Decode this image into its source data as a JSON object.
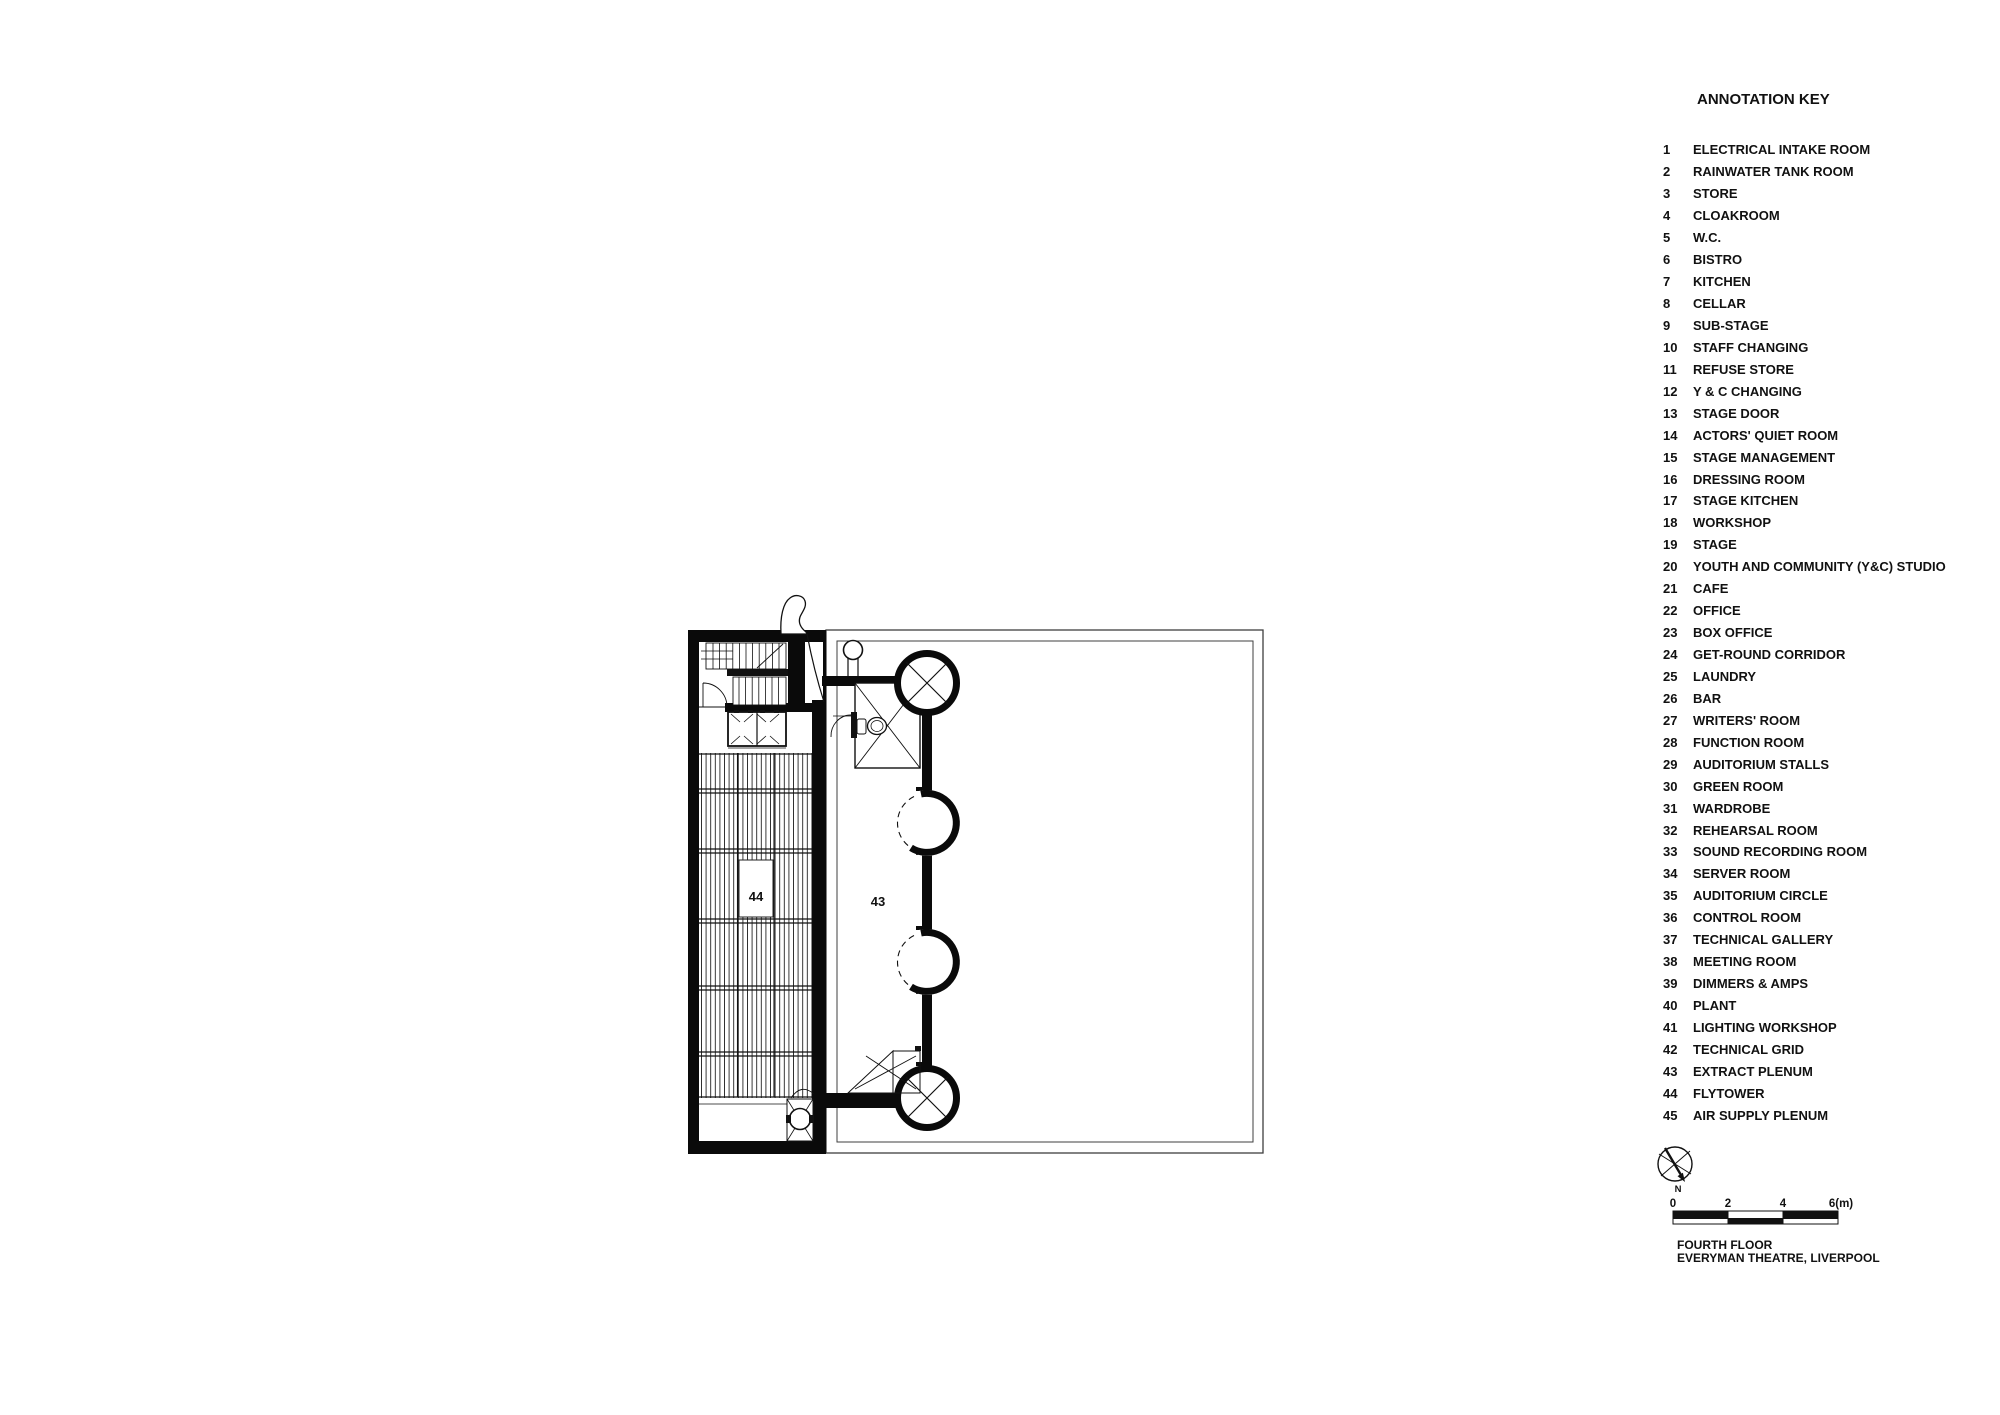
{
  "annotation_key": {
    "title": "ANNOTATION KEY",
    "items": [
      {
        "num": "1",
        "label": "ELECTRICAL INTAKE ROOM"
      },
      {
        "num": "2",
        "label": "RAINWATER TANK ROOM"
      },
      {
        "num": "3",
        "label": "STORE"
      },
      {
        "num": "4",
        "label": "CLOAKROOM"
      },
      {
        "num": "5",
        "label": "W.C."
      },
      {
        "num": "6",
        "label": "BISTRO"
      },
      {
        "num": "7",
        "label": "KITCHEN"
      },
      {
        "num": "8",
        "label": "CELLAR"
      },
      {
        "num": "9",
        "label": "SUB-STAGE"
      },
      {
        "num": "10",
        "label": "STAFF CHANGING"
      },
      {
        "num": "11",
        "label": "REFUSE STORE"
      },
      {
        "num": "12",
        "label": "Y & C CHANGING"
      },
      {
        "num": "13",
        "label": "STAGE DOOR"
      },
      {
        "num": "14",
        "label": "ACTORS' QUIET ROOM"
      },
      {
        "num": "15",
        "label": "STAGE MANAGEMENT"
      },
      {
        "num": "16",
        "label": "DRESSING ROOM"
      },
      {
        "num": "17",
        "label": "STAGE KITCHEN"
      },
      {
        "num": "18",
        "label": "WORKSHOP"
      },
      {
        "num": "19",
        "label": "STAGE"
      },
      {
        "num": "20",
        "label": "YOUTH AND COMMUNITY (Y&C) STUDIO"
      },
      {
        "num": "21",
        "label": "CAFE"
      },
      {
        "num": "22",
        "label": "OFFICE"
      },
      {
        "num": "23",
        "label": "BOX OFFICE"
      },
      {
        "num": "24",
        "label": "GET-ROUND CORRIDOR"
      },
      {
        "num": "25",
        "label": "LAUNDRY"
      },
      {
        "num": "26",
        "label": "BAR"
      },
      {
        "num": "27",
        "label": "WRITERS' ROOM"
      },
      {
        "num": "28",
        "label": "FUNCTION ROOM"
      },
      {
        "num": "29",
        "label": "AUDITORIUM STALLS"
      },
      {
        "num": "30",
        "label": "GREEN ROOM"
      },
      {
        "num": "31",
        "label": "WARDROBE"
      },
      {
        "num": "32",
        "label": "REHEARSAL ROOM"
      },
      {
        "num": "33",
        "label": "SOUND RECORDING ROOM"
      },
      {
        "num": "34",
        "label": "SERVER ROOM"
      },
      {
        "num": "35",
        "label": "AUDITORIUM CIRCLE"
      },
      {
        "num": "36",
        "label": "CONTROL ROOM"
      },
      {
        "num": "37",
        "label": "TECHNICAL GALLERY"
      },
      {
        "num": "38",
        "label": "MEETING ROOM"
      },
      {
        "num": "39",
        "label": "DIMMERS & AMPS"
      },
      {
        "num": "40",
        "label": "PLANT"
      },
      {
        "num": "41",
        "label": "LIGHTING WORKSHOP"
      },
      {
        "num": "42",
        "label": "TECHNICAL GRID"
      },
      {
        "num": "43",
        "label": "EXTRACT PLENUM"
      },
      {
        "num": "44",
        "label": "FLYTOWER"
      },
      {
        "num": "45",
        "label": "AIR SUPPLY PLENUM"
      }
    ]
  },
  "plan": {
    "labels": {
      "flytower": "44",
      "extract_plenum": "43"
    },
    "north_label": "N",
    "scale": {
      "ticks": [
        "0",
        "2",
        "4",
        "6(m)"
      ]
    },
    "title_line1": "FOURTH FLOOR",
    "title_line2": "EVERYMAN THEATRE, LIVERPOOL"
  },
  "colors": {
    "ink": "#111111",
    "wall_black": "#0a0a0a",
    "thin_line": "#3f3f3f",
    "background": "#ffffff"
  }
}
